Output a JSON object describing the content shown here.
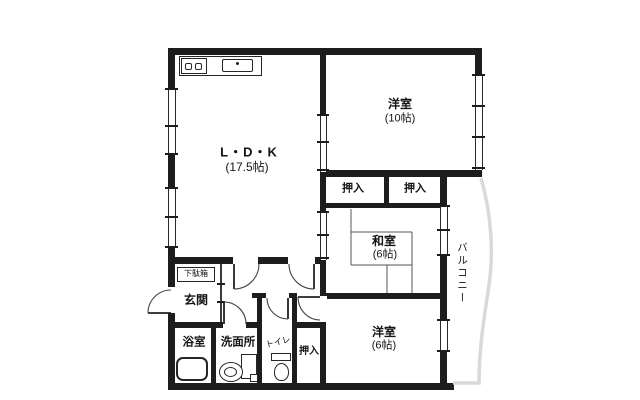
{
  "floorplan": {
    "ldk": {
      "name": "L・D・K",
      "size": "(17.5帖)"
    },
    "bedroom_10": {
      "name": "洋室",
      "size": "(10帖)"
    },
    "japanese_room": {
      "name": "和室",
      "size": "(6帖)"
    },
    "bedroom_6": {
      "name": "洋室",
      "size": "(6帖)"
    },
    "closet_1": {
      "name": "押入"
    },
    "closet_2": {
      "name": "押入"
    },
    "closet_3": {
      "name": "押入"
    },
    "balcony": {
      "name": "バルコニー"
    },
    "entrance": {
      "name": "玄関"
    },
    "shoe_cabinet": {
      "name": "下駄箱"
    },
    "bathroom": {
      "name": "浴室"
    },
    "washroom": {
      "name": "洗面所"
    },
    "toilet": {
      "name": "トイレ"
    },
    "icons": {
      "kitchen_counter": "kitchen-counter-icon",
      "stove": "stove-icon",
      "sink": "sink-icon",
      "bathtub": "bathtub-icon",
      "washbasin": "washbasin-icon",
      "washer_pan": "washer-pan-icon",
      "toilet_bowl": "toilet-icon",
      "door_arc": "door-swing-icon",
      "window": "window-icon"
    },
    "colors": {
      "wall": "#1d1d1d",
      "balcony_outline": "#d9d9d9",
      "background": "#ffffff"
    }
  }
}
